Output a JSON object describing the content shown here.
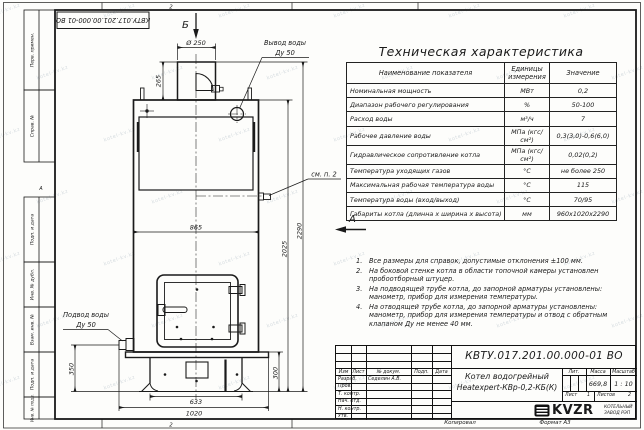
{
  "sheet": {
    "doc_number": "КВТУ.017.201.00.000-01 ВО",
    "zone_top": "2",
    "zone_bottom": "2",
    "zone_letter_left": "А",
    "frame_labels": [
      "Перв. примен.",
      "Справ. №",
      "Подп. и дата",
      "Инв. № дубл.",
      "Взам. инв. №",
      "Подп. и дата",
      "Инв. № подл."
    ],
    "watermark": "kotel-kv.kz",
    "footer": {
      "copy": "Копировал",
      "format": "Формат А3"
    }
  },
  "drawing": {
    "view_b": "Б",
    "view_a": "А",
    "dims": {
      "d250": "Ø 250",
      "h265": "265",
      "w865": "865",
      "v2025": "2025",
      "v2290": "2290",
      "v350": "350",
      "v300": "300",
      "w633": "633",
      "w1020": "1020"
    },
    "outlet_label_1": "Вывод воды",
    "outlet_label_2": "Ду 50",
    "inlet_label_1": "Подвод воды",
    "inlet_label_2": "Ду 50",
    "see_note": "см. п. 2"
  },
  "spec_table": {
    "title": "Техническая характеристика",
    "headers": [
      "Наименование показателя",
      "Единицы измерения",
      "Значение"
    ],
    "rows": [
      [
        "Номинальная мощность",
        "МВт",
        "0,2"
      ],
      [
        "Диапазон рабочего регулирования",
        "%",
        "50-100"
      ],
      [
        "Расход воды",
        "м³/ч",
        "7"
      ],
      [
        "Рабочее давление воды",
        "МПа (кгс/см²)",
        "0,3(3,0)-0,6(6,0)"
      ],
      [
        "Гидравлическое сопротивление котла",
        "МПа (кгс/см²)",
        "0,02(0,2)"
      ],
      [
        "Температура уходящих газов",
        "°С",
        "не более 250"
      ],
      [
        "Максимальная рабочая температура воды",
        "°С",
        "115"
      ],
      [
        "Температура воды (вход/выход)",
        "°С",
        "70/95"
      ],
      [
        "Габариты котла (длинна х ширина х высота)",
        "мм",
        "960х1020х2290"
      ]
    ]
  },
  "notes": [
    {
      "num": "1.",
      "text": "Все размеры для справок, допустимые отклонения ±100 мм."
    },
    {
      "num": "2.",
      "text": "На боковой стенке котла в области топочной камеры установлен пробоотборный штуцер."
    },
    {
      "num": "3.",
      "text": "На подводящей трубе котла, до запорной арматуры установлены: манометр, прибор для измерения температуры."
    },
    {
      "num": "4.",
      "text": "На отводящей трубе котла, до запорной арматуры установлены: манометр, прибор для измерения температуры и отвод с обратным клапаном Ду не менее 40 мм."
    }
  ],
  "title_block": {
    "doc_number": "КВТУ.017.201.00.000-01 ВО",
    "product_line1": "Котел водогрейный",
    "product_line2": "Heatexpert-КВр-0,2-КБ(К)",
    "cols": [
      "Изм",
      "Лист",
      "№ докум.",
      "Подп.",
      "Дата"
    ],
    "rows": [
      {
        "label": "Разраб.",
        "value": "Седелин А.В."
      },
      {
        "label": "Пров.",
        "value": ""
      },
      {
        "label": "Т. контр.",
        "value": ""
      },
      {
        "label": "Нач. отд.",
        "value": ""
      },
      {
        "label": "Н. контр.",
        "value": ""
      },
      {
        "label": "Утв.",
        "value": ""
      }
    ],
    "lit_label": "Лит.",
    "mass_label": "Масса",
    "scale_label": "Масштаб",
    "mass": "669,8",
    "scale": "1 : 10",
    "sheet_label": "Лист",
    "sheet_value": "1",
    "sheets_label": "Листов",
    "sheets_value": "2",
    "logo_text": "KVZR",
    "company_line1": "КОТЕЛЬНЫЙ",
    "company_line2": "ЗАВОД  РЭП"
  }
}
